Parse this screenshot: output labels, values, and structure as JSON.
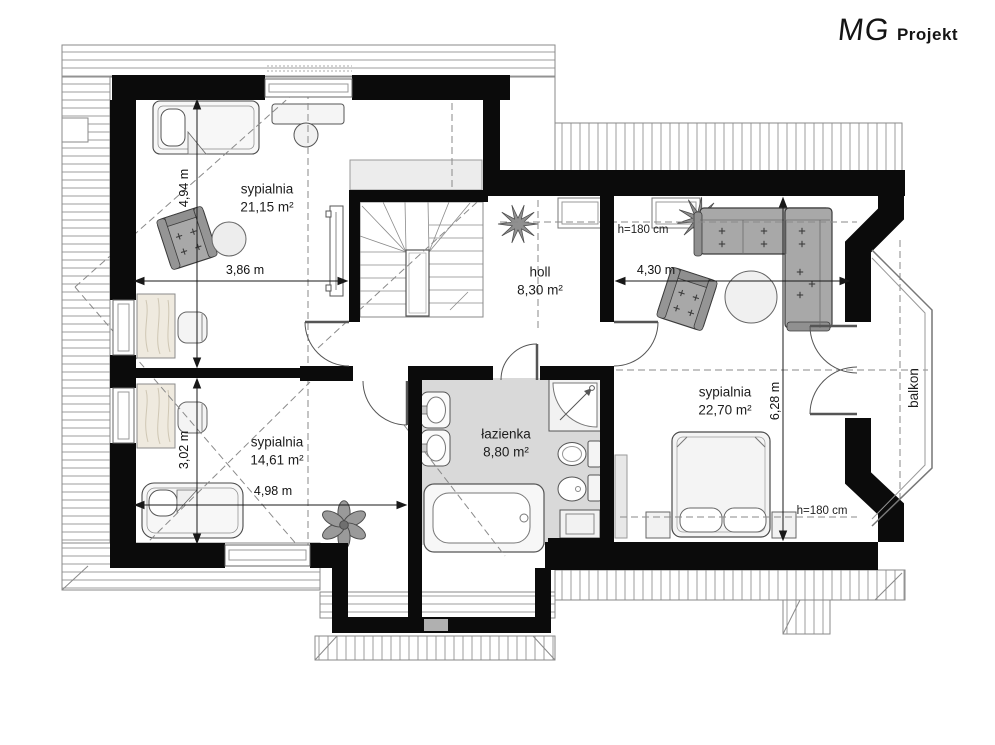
{
  "logo": {
    "brand": "MG",
    "suffix": "Projekt"
  },
  "plan": {
    "rooms": [
      {
        "key": "bedroom-top-left",
        "name": "sypialnia",
        "area": "21,15 m²"
      },
      {
        "key": "hall",
        "name": "holl",
        "area": "8,30 m²"
      },
      {
        "key": "bedroom-bottom-left",
        "name": "sypialnia",
        "area": "14,61 m²"
      },
      {
        "key": "bathroom",
        "name": "łazienka",
        "area": "8,80 m²"
      },
      {
        "key": "bedroom-right",
        "name": "sypialnia",
        "area": "22,70 m²"
      }
    ],
    "balcony_label": "balkon",
    "ceiling_heights": [
      "h=180 cm",
      "h=180 cm"
    ],
    "dimensions": {
      "left_top_vertical": "4,94 m",
      "left_top_width": "3,86 m",
      "left_bottom_vertical": "3,02 m",
      "left_bottom_width": "4,98 m",
      "hall_width": "4,30 m",
      "right_room_height": "6,28 m"
    }
  }
}
